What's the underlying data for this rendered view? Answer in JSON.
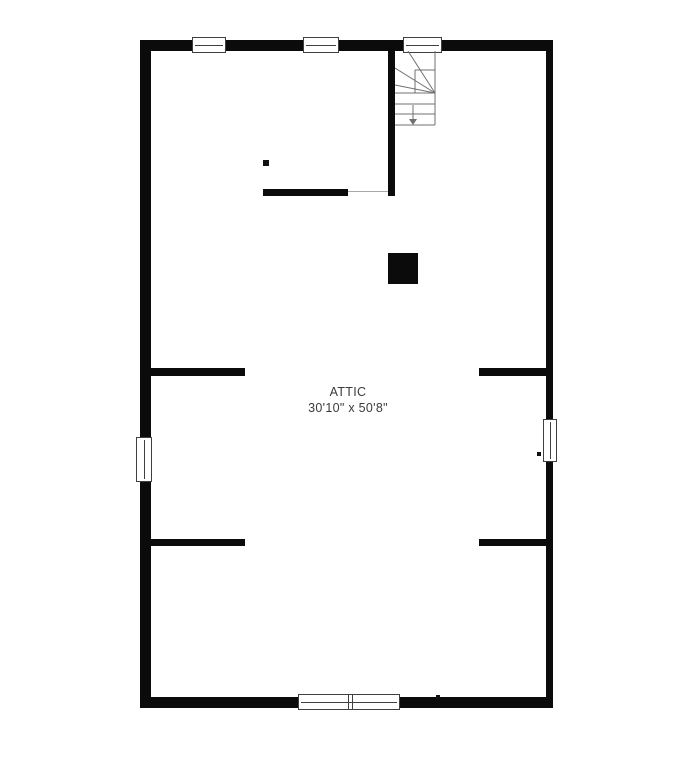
{
  "plan": {
    "title": "Attic floor plan",
    "room": {
      "name": "ATTIC",
      "dimensions": "30'10\" x 50'8\""
    },
    "stairs": {
      "type": "winder-staircase",
      "direction_arrow": "down"
    },
    "colors": {
      "wall": "#0b0b0b",
      "background": "#ffffff",
      "stair_line": "#707070",
      "window_frame": "#3f3f3f",
      "label_text": "#3b3b3b"
    }
  }
}
